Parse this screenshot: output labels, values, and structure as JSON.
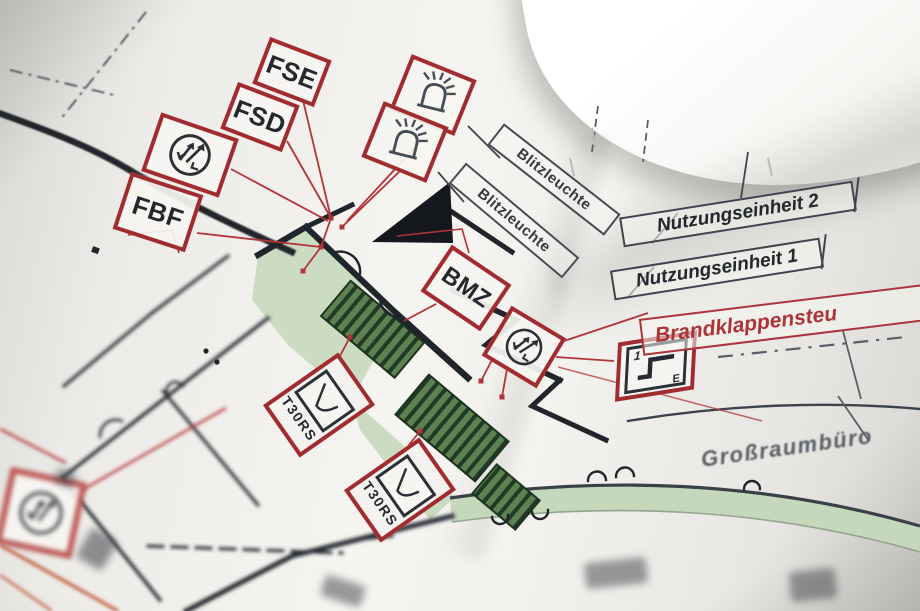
{
  "labels": {
    "fse": "FSE",
    "fsd": "FSD",
    "fbf": "FBF",
    "bmz": "BMZ",
    "blitzleuchte": "Blitzleuchte",
    "nutzungseinheit_2": "Nutzungseinheit 2",
    "nutzungseinheit_1": "Nutzungseinheit 1",
    "brandklappensteuerung": "Brandklappensteu",
    "grossraumbuero": "Großraumbüro",
    "t30rs": "T30RS"
  },
  "damper": {
    "digit": "1",
    "letter": "E"
  },
  "icons": {
    "motor": "circle-with-M-arrows",
    "beacon": "strobe-dome-with-rays",
    "door_closer": "door-swing-curve",
    "fire_damper": "step-line-1-E",
    "wedge": "solid-black-triangle"
  },
  "colors": {
    "symbol_box_red": "#a02c30",
    "leader_line_red": "#b23438",
    "brand_text_red": "#aa3439",
    "wall_black": "#20252b",
    "corridor_green_light": "#ccdcc2",
    "stair_green_dark": "#5d8150",
    "label_dark": "#23282e",
    "paper_white": "#f5f4f0",
    "background_gray": "#9e9e9c",
    "accent_orange": "#bf5330"
  }
}
